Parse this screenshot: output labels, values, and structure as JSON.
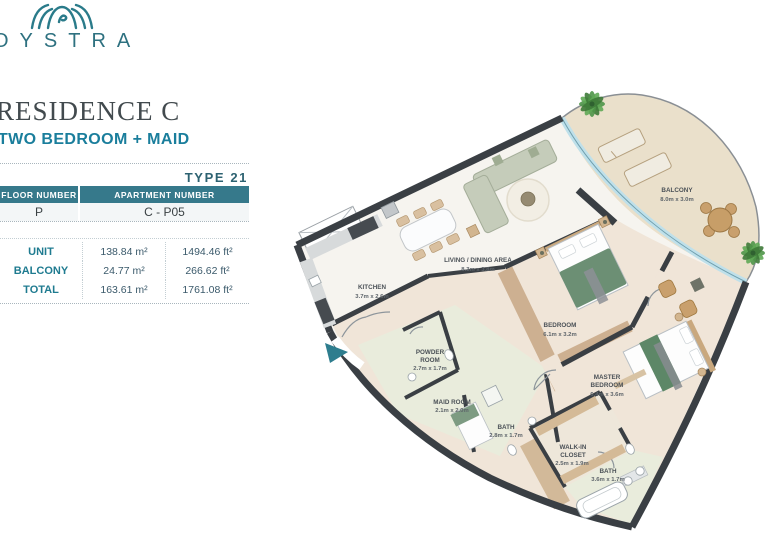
{
  "brand": {
    "name": "OYSTRA"
  },
  "header": {
    "title": "RESIDENCE C",
    "subtitle": "TWO BEDROOM + MAID",
    "type_label": "TYPE 21"
  },
  "info_table": {
    "col1_header": "FLOOR NUMBER",
    "col2_header": "APARTMENT NUMBER",
    "floor_number": "P",
    "apartment_number": "C - P05"
  },
  "area_table": {
    "rows": [
      {
        "label": "UNIT",
        "metric": "138.84 m²",
        "imperial": "1494.46 ft²"
      },
      {
        "label": "BALCONY",
        "metric": "24.77 m²",
        "imperial": "266.62 ft²"
      },
      {
        "label": "TOTAL",
        "metric": "163.61 m²",
        "imperial": "1761.08 ft²"
      }
    ]
  },
  "floor_plan": {
    "rooms": [
      {
        "name": "LIVING / DINING AREA",
        "dims": "8.3m x 3.8m"
      },
      {
        "name": "KITCHEN",
        "dims": "3.7m x 2.6m"
      },
      {
        "name": "BALCONY",
        "dims": "8.0m x 3.0m"
      },
      {
        "name": "BEDROOM",
        "dims": "6.1m x 3.2m"
      },
      {
        "name": "MASTER BEDROOM",
        "line1": "MASTER",
        "line2": "BEDROOM",
        "dims": "6.4m x 3.6m"
      },
      {
        "name": "POWDER ROOM",
        "line1": "POWDER",
        "line2": "ROOM",
        "dims": "2.7m x 1.7m"
      },
      {
        "name": "MAID ROOM",
        "dims": "2.1m x 2.0m"
      },
      {
        "name": "BATH",
        "dims": "2.8m x 1.7m"
      },
      {
        "name": "WALK-IN CLOSET",
        "line1": "WALK-IN",
        "line2": "CLOSET",
        "dims": "2.5m x 1.9m"
      },
      {
        "name": "BATH",
        "dims": "3.6m x 1.7m"
      }
    ]
  },
  "colors": {
    "accent_teal": "#2e7d8e",
    "table_header_bg": "#36798b",
    "title_teal": "#1a7e9c",
    "wall": "#3a3f44",
    "glass": "#bfe0ea"
  }
}
